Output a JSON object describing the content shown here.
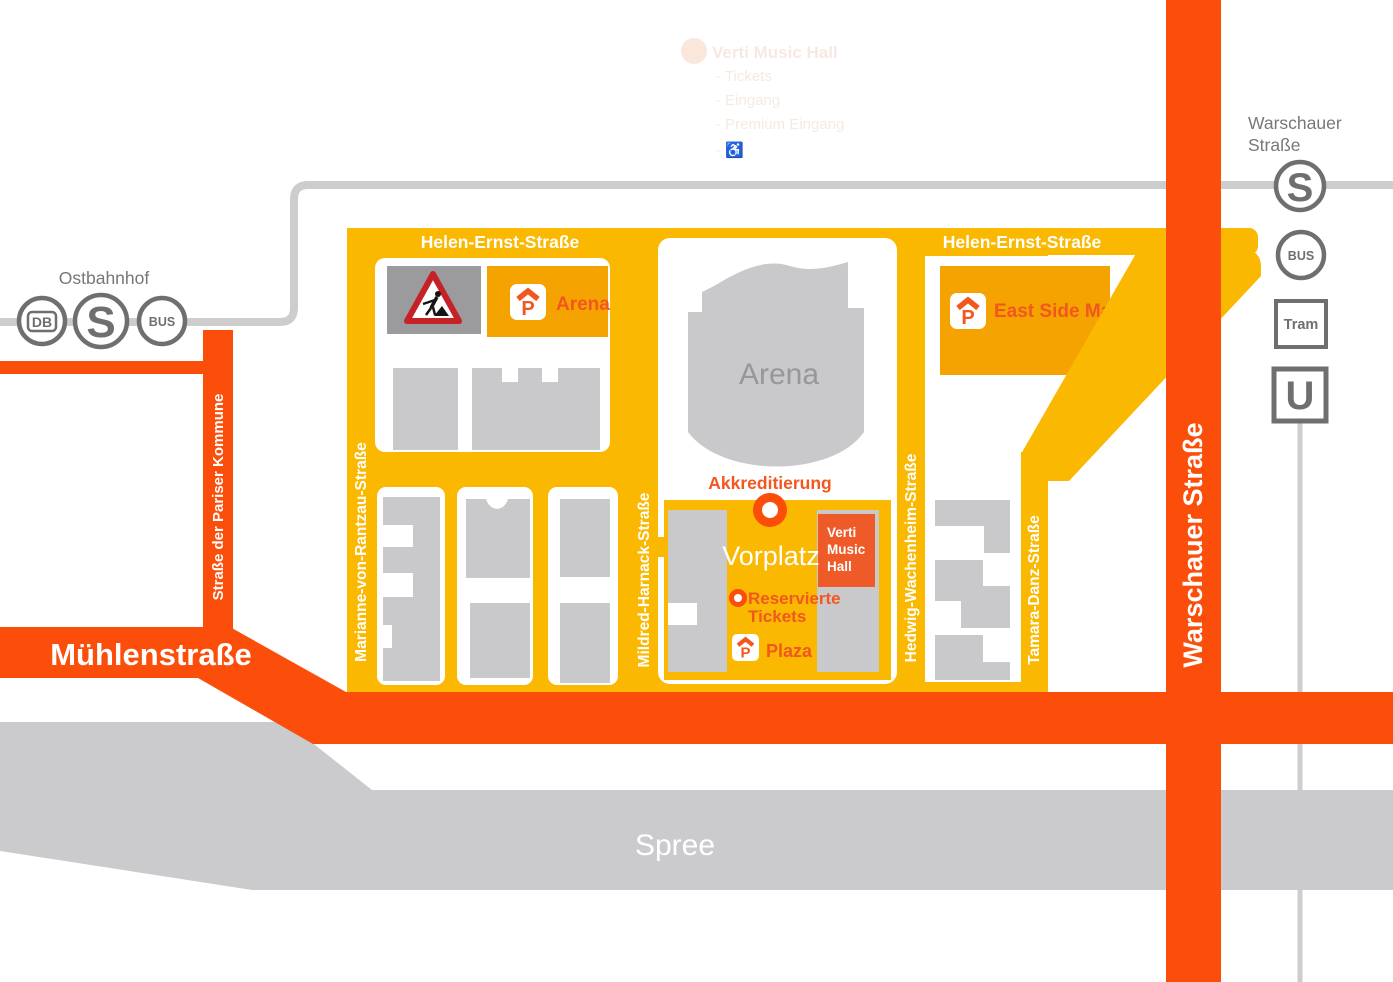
{
  "ghost_legend": {
    "title": "Verti Music Hall",
    "items": [
      "- Tickets",
      "- Eingang",
      "- Premium Eingang",
      "- ♿"
    ]
  },
  "stations": {
    "ostbahnhof": {
      "label": "Ostbahnhof",
      "icon_db": "DB",
      "icon_s": "S",
      "icon_bus": "BUS"
    },
    "warschauer": {
      "label_line1": "Warschauer",
      "label_line2": "Straße",
      "icon_s": "S",
      "icon_bus": "BUS",
      "icon_tram": "Tram",
      "icon_u": "U"
    }
  },
  "roads": {
    "muehlenstrasse": "Mühlenstraße",
    "warschauer_strasse": "Warschauer Straße",
    "pariser_kommune": "Straße der Pariser Kommune",
    "helen_ernst_left": "Helen-Ernst-Straße",
    "helen_ernst_right": "Helen-Ernst-Straße",
    "marianne": "Marianne-von-Rantzau-Straße",
    "mildred": "Mildred-Harnack-Straße",
    "hedwig": "Hedwig-Wachenheim-Straße",
    "tamara": "Tamara-Danz-Straße"
  },
  "river": {
    "label": "Spree"
  },
  "arena": {
    "label": "Arena"
  },
  "vorplatz": {
    "label": "Vorplatz"
  },
  "verti_hall": {
    "line1": "Verti",
    "line2": "Music",
    "line3": "Hall"
  },
  "markers": {
    "akkreditierung": "Akkreditierung",
    "reservierte_line1": "Reservierte",
    "reservierte_line2": "Tickets",
    "p_letter": "P",
    "parking_arena": "Arena",
    "parking_east_side": "East Side Mall",
    "parking_plaza": "Plaza"
  },
  "colors": {
    "street_yellow": "#fbb800",
    "parking_yellow": "#f5a300",
    "road_orange": "#fb4e0a",
    "accent_orange": "#f2571f",
    "verti_orange": "#ee5a28",
    "building_gray": "#c9c9cc",
    "construction_gray": "#9b9b9d",
    "river_gray": "#cbcbce",
    "rail_gray": "#cdcdcd",
    "icon_gray": "#6f6f71",
    "label_gray": "#77777a"
  }
}
